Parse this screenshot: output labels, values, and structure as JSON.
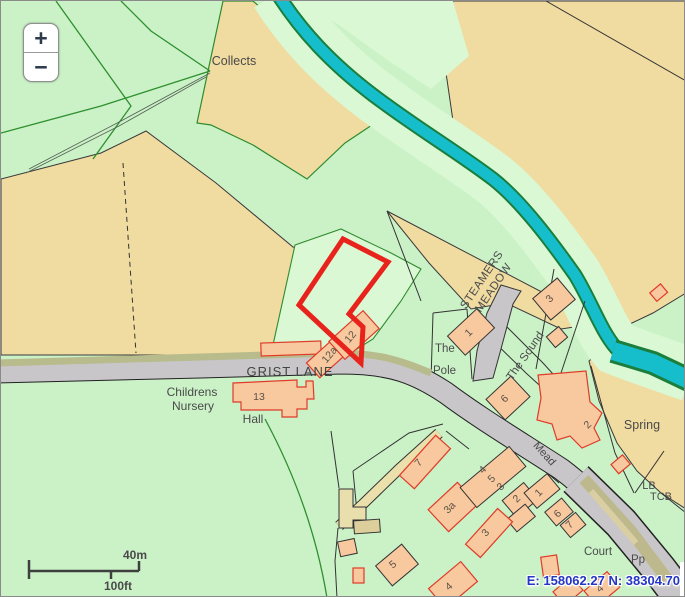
{
  "controls": {
    "zoom_in": "+",
    "zoom_out": "−"
  },
  "labels": {
    "collects": "Collects",
    "steamers_line1": "STEAMERS",
    "steamers_line2": "MEADOW",
    "grist_lane": "GRIST LANE",
    "childrens_line1": "Childrens",
    "childrens_line2": "Nursery",
    "hall": "Hall",
    "the": "The",
    "pole": "Pole",
    "the_sound": "The Sound",
    "spring": "Spring",
    "mead": "Mead",
    "court": "Court",
    "pp": "Pp",
    "lb": "LB",
    "tcb": "TCB"
  },
  "house_numbers": {
    "h12": "12",
    "h12a": "12a",
    "h13": "13",
    "p1": "1",
    "t3": "3",
    "h6": "6",
    "h2": "2",
    "h7": "7",
    "h3a": "3a",
    "r4": "4",
    "r5": "5",
    "r3": "3",
    "r2": "2",
    "r1": "1",
    "c6": "6",
    "c7": "7",
    "b3": "3",
    "b5": "5",
    "b4": "4",
    "e4": "4"
  },
  "scale_bar": {
    "metric": "40m",
    "imperial": "100ft"
  },
  "status_bar": {
    "coordinates": "E: 158062.27 N: 38304.70"
  },
  "colors": {
    "field_green": "#cbf2c7",
    "field_mint": "#d9f8d3",
    "field_tan": "#f0dba1",
    "river": "#16becc",
    "road": "#c9c6c9",
    "verge": "#b8bb8c",
    "building": "#f8c89e",
    "building_border_red": "#e03a28",
    "selection_red": "#e8231c",
    "coord_blue": "#2336c4"
  }
}
